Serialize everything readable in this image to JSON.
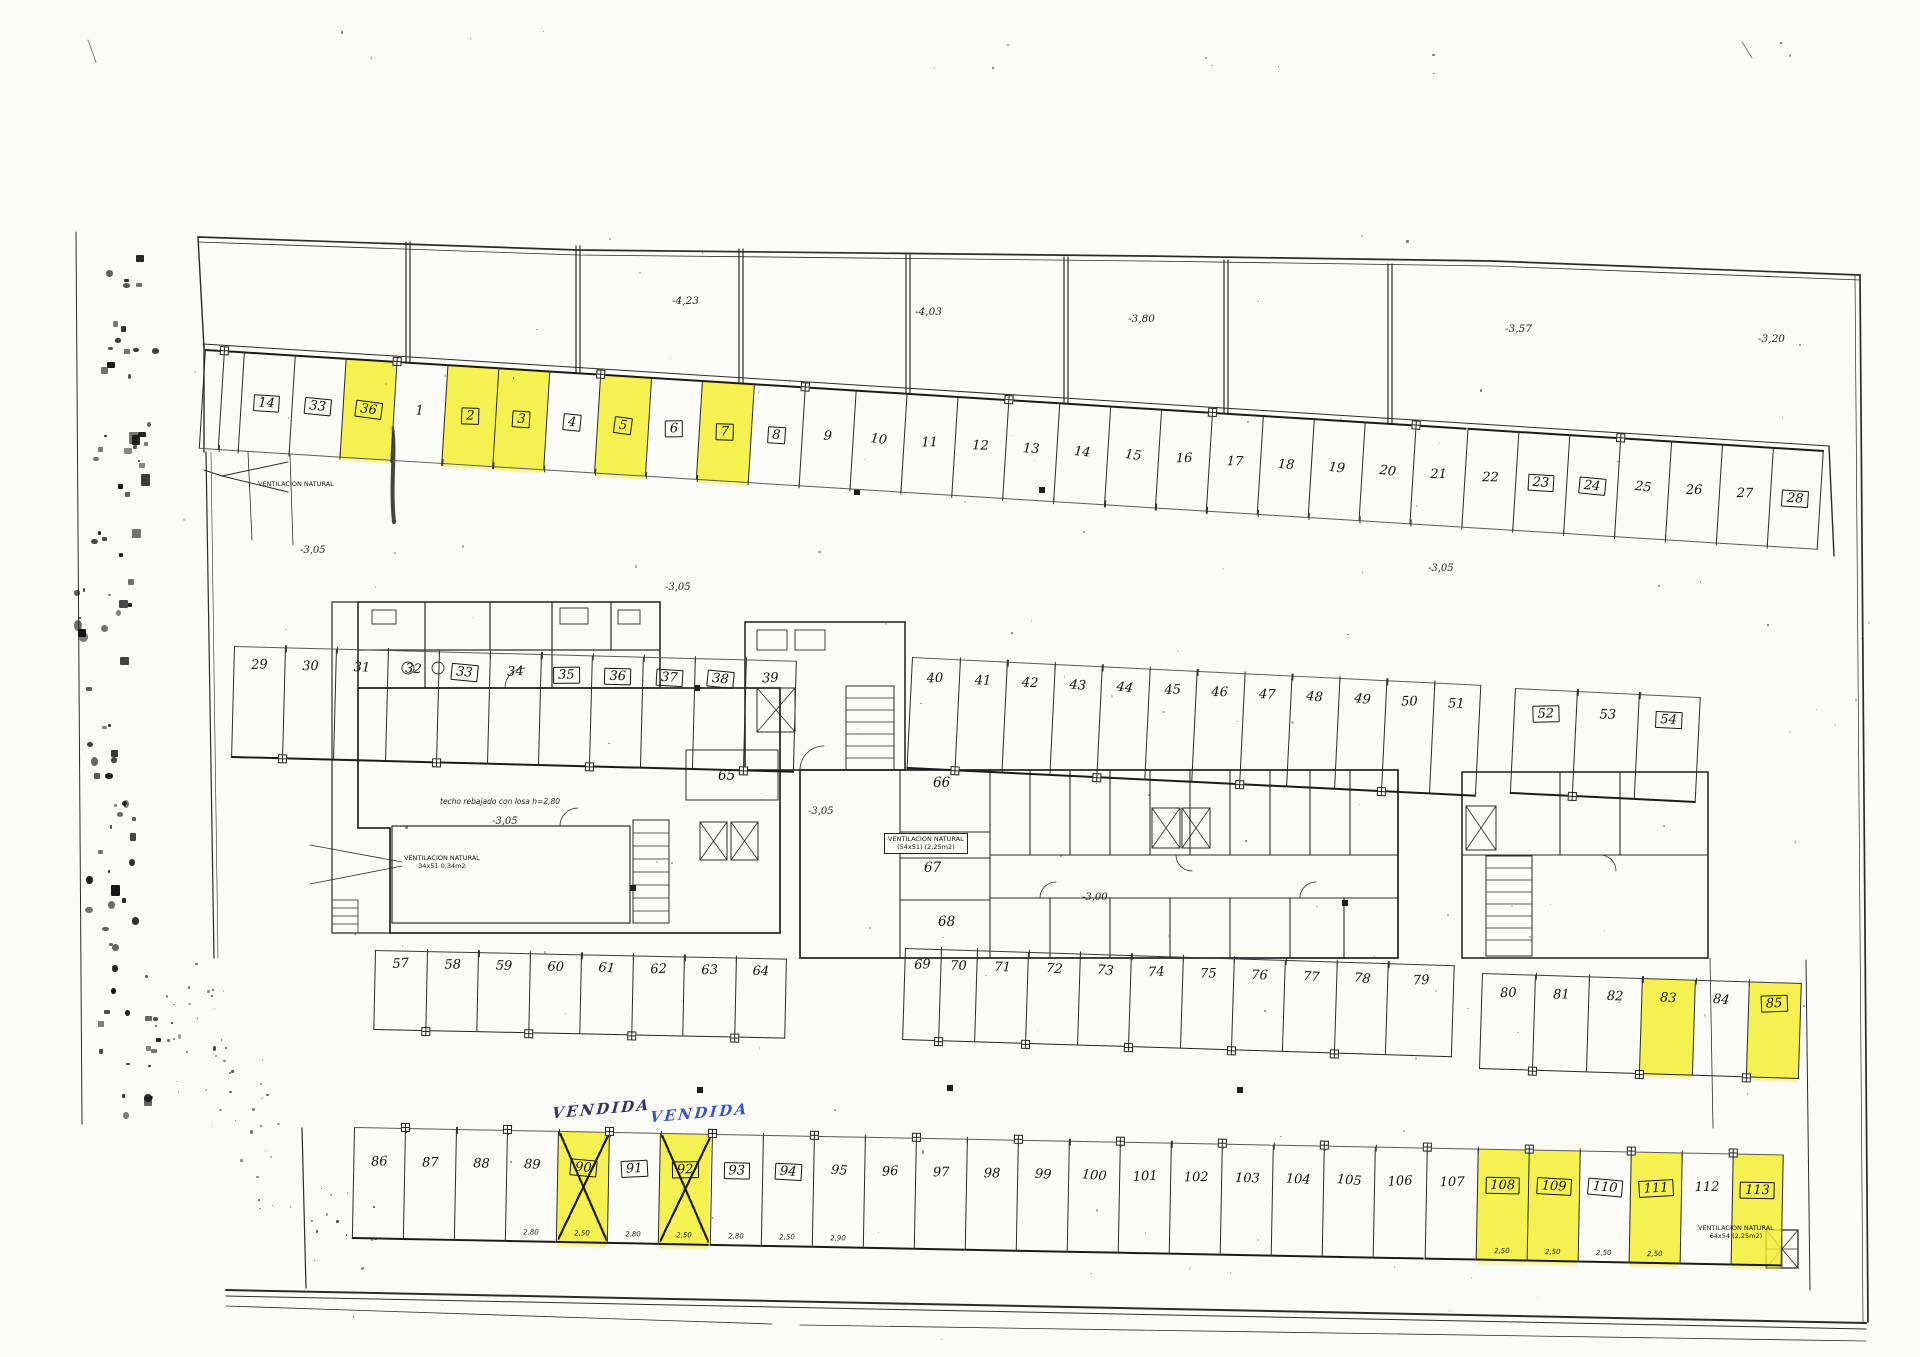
{
  "plan": {
    "highlight_color": "#f3ee2b",
    "elevation_labels": [
      "-4,23",
      "-4,03",
      "-3,80",
      "-3,57",
      "-3,20"
    ],
    "level_labels": [
      "-3,05",
      "-3,05",
      "-3,05",
      "-3,05",
      "-3,05",
      "-3,00"
    ],
    "room_labels": [
      "65",
      "66",
      "67",
      "68"
    ],
    "note_ceiling": "techo rebajado con losa h=2,80",
    "vendida_labels": [
      {
        "text": "VENDIDA",
        "ink": "#32325e"
      },
      {
        "text": "VENDIDA",
        "ink": "#3c55c4"
      }
    ],
    "vent_annotations": [
      {
        "lines": [
          "VENTILACION NATURAL"
        ],
        "boxed": false
      },
      {
        "lines": [
          "VENTILACION NATURAL",
          "34x51 0,34m2"
        ],
        "boxed": false
      },
      {
        "lines": [
          "VENTILACION NATURAL",
          "(54x51) (2,25m2)"
        ],
        "boxed": true
      },
      {
        "lines": [
          "VENTILACION NATURAL",
          "64x54 (2,25m2)"
        ],
        "boxed": false
      }
    ],
    "rows": {
      "r1": {
        "spaces": [
          {
            "n": ""
          },
          {
            "n": ""
          },
          {
            "n": "14",
            "box": true
          },
          {
            "n": "33",
            "box": true
          },
          {
            "n": "36",
            "box": true,
            "hl": true
          },
          {
            "n": "1"
          },
          {
            "n": "2",
            "box": true,
            "hl": true
          },
          {
            "n": "3",
            "box": true,
            "hl": true
          },
          {
            "n": "4",
            "box": true
          },
          {
            "n": "5",
            "box": true,
            "hl": true
          },
          {
            "n": "6",
            "box": true
          },
          {
            "n": "7",
            "box": true,
            "hl": true
          },
          {
            "n": "8",
            "box": true
          },
          {
            "n": "9"
          },
          {
            "n": "10"
          },
          {
            "n": "11"
          },
          {
            "n": "12"
          },
          {
            "n": "13"
          },
          {
            "n": "14"
          },
          {
            "n": "15"
          },
          {
            "n": "16"
          },
          {
            "n": "17"
          },
          {
            "n": "18"
          },
          {
            "n": "19"
          },
          {
            "n": "20"
          },
          {
            "n": "21"
          },
          {
            "n": "22"
          },
          {
            "n": "23",
            "box": true
          },
          {
            "n": "24",
            "box": true
          },
          {
            "n": "25"
          },
          {
            "n": "26"
          },
          {
            "n": "27"
          },
          {
            "n": "28",
            "box": true
          }
        ]
      },
      "r2a": {
        "spaces": [
          {
            "n": "29"
          },
          {
            "n": "30"
          },
          {
            "n": "31"
          },
          {
            "n": "32"
          },
          {
            "n": "33",
            "box": true
          },
          {
            "n": "34"
          },
          {
            "n": "35",
            "box": true
          },
          {
            "n": "36",
            "box": true
          },
          {
            "n": "37",
            "box": true
          },
          {
            "n": "38",
            "box": true
          },
          {
            "n": "39"
          }
        ]
      },
      "r2b": {
        "spaces": [
          {
            "n": "40"
          },
          {
            "n": "41"
          },
          {
            "n": "42"
          },
          {
            "n": "43"
          },
          {
            "n": "44"
          },
          {
            "n": "45"
          },
          {
            "n": "46"
          },
          {
            "n": "47"
          },
          {
            "n": "48"
          },
          {
            "n": "49"
          },
          {
            "n": "50"
          },
          {
            "n": "51"
          }
        ]
      },
      "r2c": {
        "spaces": [
          {
            "n": "52",
            "box": true
          },
          {
            "n": "53"
          },
          {
            "n": "54",
            "box": true
          }
        ]
      },
      "r3a": {
        "spaces": [
          {
            "n": "57"
          },
          {
            "n": "58"
          },
          {
            "n": "59"
          },
          {
            "n": "60"
          },
          {
            "n": "61"
          },
          {
            "n": "62"
          },
          {
            "n": "63"
          },
          {
            "n": "64"
          }
        ]
      },
      "r3b": {
        "spaces": [
          {
            "n": "69"
          },
          {
            "n": "70"
          },
          {
            "n": "71"
          },
          {
            "n": "72"
          },
          {
            "n": "73"
          },
          {
            "n": "74"
          },
          {
            "n": "75"
          },
          {
            "n": "76"
          },
          {
            "n": "77"
          },
          {
            "n": "78"
          },
          {
            "n": "79"
          }
        ]
      },
      "r3c": {
        "spaces": [
          {
            "n": "80"
          },
          {
            "n": "81"
          },
          {
            "n": "82"
          },
          {
            "n": "83",
            "hl": true
          },
          {
            "n": "84"
          },
          {
            "n": "85",
            "box": true,
            "hl": true
          }
        ]
      },
      "r4": {
        "spaces": [
          {
            "n": "86"
          },
          {
            "n": "87"
          },
          {
            "n": "88"
          },
          {
            "n": "89",
            "dim": "2,80"
          },
          {
            "n": "90",
            "box": true,
            "hl": true,
            "x": true,
            "dim": "2,50"
          },
          {
            "n": "91",
            "box": true,
            "dim": "2,80"
          },
          {
            "n": "92",
            "box": true,
            "hl": true,
            "x": true,
            "dim": "2,50"
          },
          {
            "n": "93",
            "box": true,
            "dim": "2,80"
          },
          {
            "n": "94",
            "box": true,
            "dim": "2,50"
          },
          {
            "n": "95",
            "dim": "2,90"
          },
          {
            "n": "96"
          },
          {
            "n": "97"
          },
          {
            "n": "98"
          },
          {
            "n": "99"
          },
          {
            "n": "100"
          },
          {
            "n": "101"
          },
          {
            "n": "102"
          },
          {
            "n": "103"
          },
          {
            "n": "104"
          },
          {
            "n": "105"
          },
          {
            "n": "106"
          },
          {
            "n": "107"
          },
          {
            "n": "108",
            "box": true,
            "hl": true,
            "dim": "2,50"
          },
          {
            "n": "109",
            "box": true,
            "hl": true,
            "dim": "2,50"
          },
          {
            "n": "110",
            "box": true,
            "dim": "2,50"
          },
          {
            "n": "111",
            "box": true,
            "hl": true,
            "dim": "2,50"
          },
          {
            "n": "112"
          },
          {
            "n": "113",
            "box": true,
            "hl": true
          }
        ]
      }
    }
  }
}
